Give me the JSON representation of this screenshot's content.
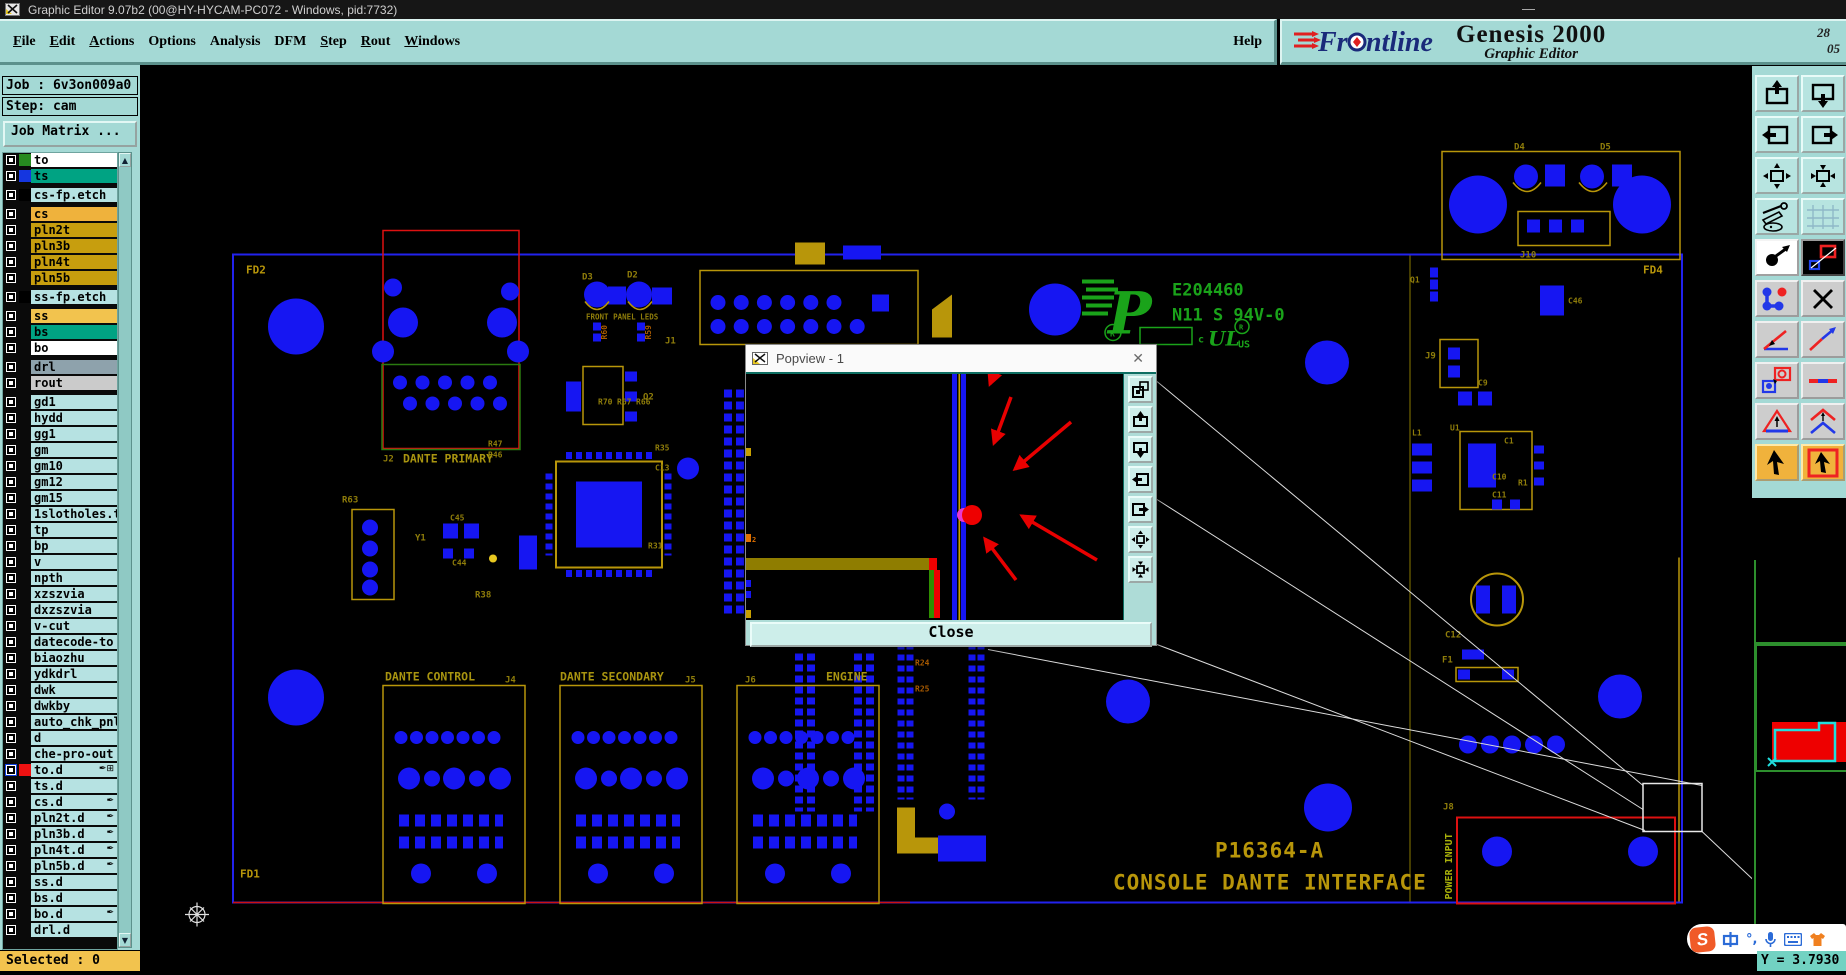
{
  "window": {
    "title": "Graphic Editor 9.07b2 (00@HY-HYCAM-PC072 - Windows, pid:7732)",
    "minimize_glyph": "—"
  },
  "menubar": {
    "items": [
      {
        "mn": "F",
        "rest": "ile"
      },
      {
        "mn": "E",
        "rest": "dit"
      },
      {
        "mn": "A",
        "rest": "ctions"
      },
      {
        "mn": "",
        "rest": "Options"
      },
      {
        "mn": "",
        "rest": "Analysis"
      },
      {
        "mn": "",
        "rest": "DFM"
      },
      {
        "mn": "S",
        "rest": "tep"
      },
      {
        "mn": "R",
        "rest": "out"
      },
      {
        "mn": "W",
        "rest": "indows"
      }
    ],
    "help": "Help"
  },
  "brand": {
    "logo_text": "Frontline",
    "product": "Genesis 2000",
    "subtitle": "Graphic Editor",
    "stamp_top": "28",
    "stamp_bottom": "05"
  },
  "job_panel": {
    "job_label": "Job : 6v3on009a0",
    "step_label": "Step: cam",
    "matrix_button": "Job Matrix ..."
  },
  "layer_list": {
    "rows": [
      {
        "name": "to",
        "bg": "#ffffff",
        "swatch": "#268a20",
        "gap": "0px",
        "box": "#0a0a0a",
        "icons": ""
      },
      {
        "name": "ts",
        "bg": "#00a383",
        "swatch": "#1536e0",
        "gap": "0px",
        "box": "#0a0a0a",
        "icons": ""
      },
      {
        "name": "cs-fp.etch",
        "bg": "#b6e2e2",
        "swatch": "#000000",
        "gap": "5px",
        "box": "#0a0a0a",
        "icons": ""
      },
      {
        "name": "cs",
        "bg": "#efb23c",
        "swatch": "transparent",
        "gap": "5px",
        "box": "#0a0a0a",
        "icons": ""
      },
      {
        "name": "pln2t",
        "bg": "#c79e0e",
        "swatch": "transparent",
        "gap": "0px",
        "box": "#0a0a0a",
        "icons": ""
      },
      {
        "name": "pln3b",
        "bg": "#c79e0e",
        "swatch": "transparent",
        "gap": "0px",
        "box": "#0a0a0a",
        "icons": ""
      },
      {
        "name": "pln4t",
        "bg": "#c79e0e",
        "swatch": "transparent",
        "gap": "0px",
        "box": "#0a0a0a",
        "icons": ""
      },
      {
        "name": "pln5b",
        "bg": "#c79e0e",
        "swatch": "transparent",
        "gap": "0px",
        "box": "#0a0a0a",
        "icons": ""
      },
      {
        "name": "ss-fp.etch",
        "bg": "#b6e2e2",
        "swatch": "#000000",
        "gap": "5px",
        "box": "#0a0a0a",
        "icons": ""
      },
      {
        "name": "ss",
        "bg": "#f2c34e",
        "swatch": "transparent",
        "gap": "5px",
        "box": "#0a0a0a",
        "icons": ""
      },
      {
        "name": "bs",
        "bg": "#00a383",
        "swatch": "transparent",
        "gap": "0px",
        "box": "#0a0a0a",
        "icons": ""
      },
      {
        "name": "bo",
        "bg": "#ffffff",
        "swatch": "transparent",
        "gap": "0px",
        "box": "#0a0a0a",
        "icons": ""
      },
      {
        "name": "drl",
        "bg": "#8ea2ac",
        "swatch": "transparent",
        "gap": "5px",
        "box": "#0a0a0a",
        "icons": ""
      },
      {
        "name": "rout",
        "bg": "#cbcbcb",
        "swatch": "transparent",
        "gap": "0px",
        "box": "#0a0a0a",
        "icons": ""
      },
      {
        "name": "gd1",
        "bg": "#b6e2e2",
        "swatch": "transparent",
        "gap": "5px",
        "box": "#0a0a0a",
        "icons": ""
      },
      {
        "name": "hydd",
        "bg": "#b6e2e2",
        "swatch": "transparent",
        "gap": "0px",
        "box": "#0a0a0a",
        "icons": ""
      },
      {
        "name": "gg1",
        "bg": "#b6e2e2",
        "swatch": "transparent",
        "gap": "0px",
        "box": "#0a0a0a",
        "icons": ""
      },
      {
        "name": "gm",
        "bg": "#b6e2e2",
        "swatch": "transparent",
        "gap": "0px",
        "box": "#0a0a0a",
        "icons": ""
      },
      {
        "name": "gm10",
        "bg": "#b6e2e2",
        "swatch": "transparent",
        "gap": "0px",
        "box": "#0a0a0a",
        "icons": ""
      },
      {
        "name": "gm12",
        "bg": "#b6e2e2",
        "swatch": "transparent",
        "gap": "0px",
        "box": "#0a0a0a",
        "icons": ""
      },
      {
        "name": "gm15",
        "bg": "#b6e2e2",
        "swatch": "transparent",
        "gap": "0px",
        "box": "#0a0a0a",
        "icons": ""
      },
      {
        "name": "1slotholes.t",
        "bg": "#b6e2e2",
        "swatch": "transparent",
        "gap": "0px",
        "box": "#0a0a0a",
        "icons": ""
      },
      {
        "name": "tp",
        "bg": "#b6e2e2",
        "swatch": "transparent",
        "gap": "0px",
        "box": "#0a0a0a",
        "icons": ""
      },
      {
        "name": "bp",
        "bg": "#b6e2e2",
        "swatch": "transparent",
        "gap": "0px",
        "box": "#0a0a0a",
        "icons": ""
      },
      {
        "name": "v",
        "bg": "#b6e2e2",
        "swatch": "transparent",
        "gap": "0px",
        "box": "#0a0a0a",
        "icons": ""
      },
      {
        "name": "npth",
        "bg": "#b6e2e2",
        "swatch": "transparent",
        "gap": "0px",
        "box": "#0a0a0a",
        "icons": ""
      },
      {
        "name": "xzszvia",
        "bg": "#b6e2e2",
        "swatch": "transparent",
        "gap": "0px",
        "box": "#0a0a0a",
        "icons": ""
      },
      {
        "name": "dxzszvia",
        "bg": "#b6e2e2",
        "swatch": "transparent",
        "gap": "0px",
        "box": "#0a0a0a",
        "icons": ""
      },
      {
        "name": "v-cut",
        "bg": "#b6e2e2",
        "swatch": "transparent",
        "gap": "0px",
        "box": "#0a0a0a",
        "icons": ""
      },
      {
        "name": "datecode-to",
        "bg": "#b6e2e2",
        "swatch": "transparent",
        "gap": "0px",
        "box": "#0a0a0a",
        "icons": ""
      },
      {
        "name": "biaozhu",
        "bg": "#b6e2e2",
        "swatch": "transparent",
        "gap": "0px",
        "box": "#0a0a0a",
        "icons": ""
      },
      {
        "name": "ydkdrl",
        "bg": "#b6e2e2",
        "swatch": "transparent",
        "gap": "0px",
        "box": "#0a0a0a",
        "icons": ""
      },
      {
        "name": "dwk",
        "bg": "#b6e2e2",
        "swatch": "transparent",
        "gap": "0px",
        "box": "#0a0a0a",
        "icons": ""
      },
      {
        "name": "dwkby",
        "bg": "#b6e2e2",
        "swatch": "transparent",
        "gap": "0px",
        "box": "#0a0a0a",
        "icons": ""
      },
      {
        "name": "auto_chk_pnl",
        "bg": "#b6e2e2",
        "swatch": "transparent",
        "gap": "0px",
        "box": "#0a0a0a",
        "icons": ""
      },
      {
        "name": "d",
        "bg": "#b6e2e2",
        "swatch": "transparent",
        "gap": "0px",
        "box": "#0a0a0a",
        "icons": ""
      },
      {
        "name": "che-pro-out",
        "bg": "#b6e2e2",
        "swatch": "transparent",
        "gap": "0px",
        "box": "#0a0a0a",
        "icons": ""
      },
      {
        "name": "to.d",
        "bg": "#b6e2e2",
        "swatch": "#ee1111",
        "gap": "0px",
        "box": "#1040e0",
        "icons": "✒⊞"
      },
      {
        "name": "ts.d",
        "bg": "#b6e2e2",
        "swatch": "transparent",
        "gap": "0px",
        "box": "#0a0a0a",
        "icons": ""
      },
      {
        "name": "cs.d",
        "bg": "#b6e2e2",
        "swatch": "transparent",
        "gap": "0px",
        "box": "#0a0a0a",
        "icons": "✒"
      },
      {
        "name": "pln2t.d",
        "bg": "#b6e2e2",
        "swatch": "transparent",
        "gap": "0px",
        "box": "#0a0a0a",
        "icons": "✒"
      },
      {
        "name": "pln3b.d",
        "bg": "#b6e2e2",
        "swatch": "transparent",
        "gap": "0px",
        "box": "#0a0a0a",
        "icons": "✒"
      },
      {
        "name": "pln4t.d",
        "bg": "#b6e2e2",
        "swatch": "transparent",
        "gap": "0px",
        "box": "#0a0a0a",
        "icons": "✒"
      },
      {
        "name": "pln5b.d",
        "bg": "#b6e2e2",
        "swatch": "transparent",
        "gap": "0px",
        "box": "#0a0a0a",
        "icons": "✒"
      },
      {
        "name": "ss.d",
        "bg": "#b6e2e2",
        "swatch": "transparent",
        "gap": "0px",
        "box": "#0a0a0a",
        "icons": ""
      },
      {
        "name": "bs.d",
        "bg": "#b6e2e2",
        "swatch": "transparent",
        "gap": "0px",
        "box": "#0a0a0a",
        "icons": ""
      },
      {
        "name": "bo.d",
        "bg": "#b6e2e2",
        "swatch": "transparent",
        "gap": "0px",
        "box": "#0a0a0a",
        "icons": "✒"
      },
      {
        "name": "drl.d",
        "bg": "#b6e2e2",
        "swatch": "transparent",
        "gap": "0px",
        "box": "#0a0a0a",
        "icons": ""
      }
    ]
  },
  "status": {
    "selected": "Selected : 0",
    "y_readout": "Y = 3.7930"
  },
  "popview": {
    "title": "Popview - 1",
    "close_label": "Close",
    "tick_label": "2",
    "buttons": [
      "copy-view",
      "shift-up",
      "shift-down",
      "shift-left",
      "shift-right",
      "zoom-expand",
      "zoom-contract"
    ]
  },
  "right_toolbar": {
    "buttons": [
      "shift-up",
      "shift-down",
      "shift-left",
      "shift-right",
      "expand-view",
      "contract-view",
      "setup-tools",
      "grid",
      "zoom-area",
      "layer-compare",
      "netlist",
      "clear-marks",
      "measure-angle",
      "measure-line",
      "pad-compare",
      "segment",
      "truesize-triangle",
      "truesize-chevron",
      "select-cursor",
      "select-cursor-boxed"
    ]
  },
  "ime": {
    "lang": "中",
    "punct": "°,"
  },
  "pcb": {
    "labels": {
      "fd2": "FD2",
      "fd1": "FD1",
      "fd4": "FD4",
      "d3": "D3",
      "d2": "D2",
      "front_panel_leds": "FRONT PANEL LEDS",
      "r60": "R60",
      "r59": "R59",
      "j1": "J1",
      "q2": "Q2",
      "j2": "J2",
      "dante_primary": "DANTE PRIMARY",
      "r63": "R63",
      "y1": "Y1",
      "c44": "C44",
      "c45": "C45",
      "r38": "R38",
      "r47": "R47",
      "r46": "R46",
      "r70": "R70",
      "r67": "R67",
      "r66": "R66",
      "r35": "R35",
      "c13": "C13",
      "r31": "R31",
      "ul_number": "E204460",
      "ul_rating": "N11 S 94V-0",
      "ul_c": "c",
      "ul_ul": "UL",
      "ul_us": "US",
      "ul_r": "R",
      "dante_control": "DANTE CONTROL",
      "j4": "J4",
      "dante_secondary": "DANTE SECONDARY",
      "j5": "J5",
      "j6": "J6",
      "engine": "ENGINE",
      "r24": "R24",
      "r25": "R25",
      "part_number": "P16364-A",
      "board_name": "CONSOLE DANTE INTERFACE",
      "power_input": "POWER INPUT",
      "j8": "J8",
      "d4": "D4",
      "d5": "D5",
      "j10": "J10",
      "q1": "Q1",
      "c46": "C46",
      "j9": "J9",
      "c9": "C9",
      "u1": "U1",
      "l1": "L1",
      "c1": "C1",
      "c10": "C10",
      "c11": "C11",
      "r1": "R1",
      "c12": "C12",
      "f1": "F1"
    }
  }
}
